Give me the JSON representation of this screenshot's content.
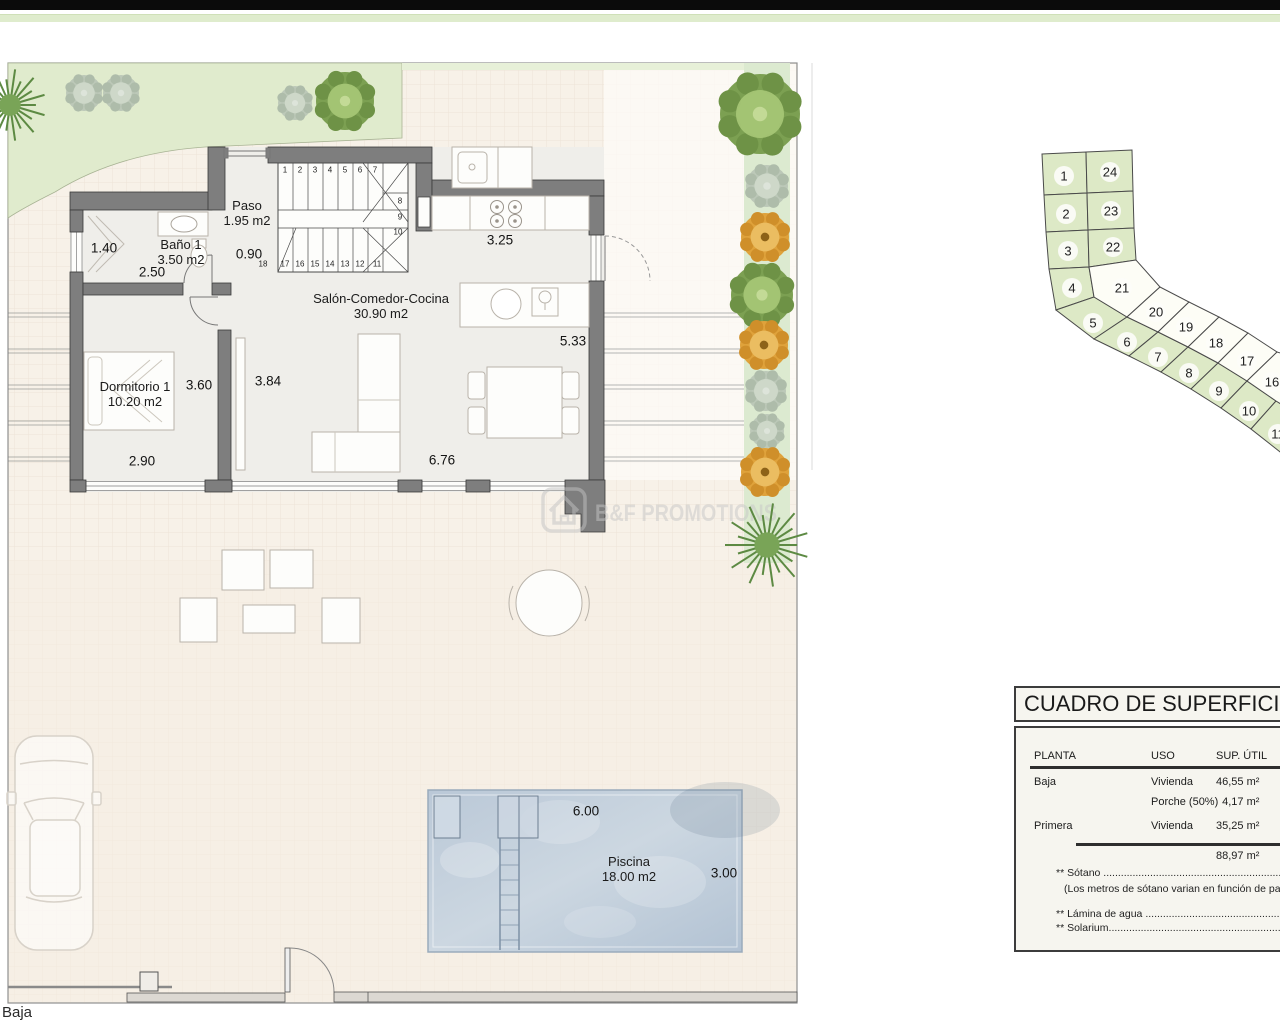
{
  "page": {
    "floor_label": "Baja"
  },
  "watermark": {
    "text": "B&F PROMOTIONS"
  },
  "rooms": [
    {
      "name": "Paso",
      "area": "1.95 m2",
      "x": 247,
      "y": 213
    },
    {
      "name": "Baño 1",
      "area": "3.50 m2",
      "x": 181,
      "y": 252
    },
    {
      "name": "Salón-Comedor-Cocina",
      "area": "30.90 m2",
      "x": 381,
      "y": 306
    },
    {
      "name": "Dormitorio 1",
      "area": "10.20 m2",
      "x": 135,
      "y": 394
    },
    {
      "name": "Piscina",
      "area": "18.00 m2",
      "x": 629,
      "y": 869
    }
  ],
  "dimensions": [
    {
      "text": "1.40",
      "x": 104,
      "y": 248
    },
    {
      "text": "2.50",
      "x": 152,
      "y": 272
    },
    {
      "text": "0.90",
      "x": 249,
      "y": 254
    },
    {
      "text": "3.25",
      "x": 500,
      "y": 240
    },
    {
      "text": "5.33",
      "x": 573,
      "y": 341
    },
    {
      "text": "3.60",
      "x": 199,
      "y": 385
    },
    {
      "text": "3.84",
      "x": 268,
      "y": 381
    },
    {
      "text": "2.90",
      "x": 142,
      "y": 461
    },
    {
      "text": "6.76",
      "x": 442,
      "y": 460
    },
    {
      "text": "6.00",
      "x": 586,
      "y": 811
    },
    {
      "text": "3.00",
      "x": 724,
      "y": 873
    }
  ],
  "stairs": {
    "numbers": [
      {
        "n": "1",
        "x": 285,
        "y": 170
      },
      {
        "n": "2",
        "x": 300,
        "y": 170
      },
      {
        "n": "3",
        "x": 315,
        "y": 170
      },
      {
        "n": "4",
        "x": 330,
        "y": 170
      },
      {
        "n": "5",
        "x": 345,
        "y": 170
      },
      {
        "n": "6",
        "x": 360,
        "y": 170
      },
      {
        "n": "7",
        "x": 375,
        "y": 170
      },
      {
        "n": "8",
        "x": 400,
        "y": 201
      },
      {
        "n": "9",
        "x": 400,
        "y": 217
      },
      {
        "n": "10",
        "x": 398,
        "y": 232
      },
      {
        "n": "18",
        "x": 263,
        "y": 264
      },
      {
        "n": "17",
        "x": 285,
        "y": 264
      },
      {
        "n": "16",
        "x": 300,
        "y": 264
      },
      {
        "n": "15",
        "x": 315,
        "y": 264
      },
      {
        "n": "14",
        "x": 330,
        "y": 264
      },
      {
        "n": "13",
        "x": 345,
        "y": 264
      },
      {
        "n": "12",
        "x": 360,
        "y": 264
      },
      {
        "n": "11",
        "x": 377,
        "y": 264
      }
    ]
  },
  "plot_map": {
    "green_color": "#dde9c6",
    "white_color": "#fdfdf6",
    "plots": [
      {
        "n": "1",
        "green": true,
        "points": "12,14 56,12 57,53 14,55",
        "lx": 34,
        "ly": 36
      },
      {
        "n": "2",
        "green": true,
        "points": "14,55 57,53 58,90 16,92",
        "lx": 36,
        "ly": 74
      },
      {
        "n": "3",
        "green": true,
        "points": "16,92 58,90 59,127 19,129",
        "lx": 38,
        "ly": 111
      },
      {
        "n": "4",
        "green": true,
        "points": "19,129 59,127 64,157 26,170",
        "lx": 42,
        "ly": 148
      },
      {
        "n": "5",
        "green": true,
        "points": "26,170 64,157 97,177 64,199",
        "lx": 63,
        "ly": 183
      },
      {
        "n": "6",
        "green": true,
        "points": "64,199 97,177 128,192 99,216",
        "lx": 97,
        "ly": 202
      },
      {
        "n": "7",
        "green": true,
        "points": "99,216 128,192 158,207 131,232",
        "lx": 128,
        "ly": 217
      },
      {
        "n": "8",
        "green": true,
        "points": "131,232 158,207 188,223 161,249",
        "lx": 159,
        "ly": 233
      },
      {
        "n": "9",
        "green": true,
        "points": "161,249 188,223 217,241 191,268",
        "lx": 189,
        "ly": 251
      },
      {
        "n": "10",
        "green": true,
        "points": "191,268 217,241 246,261 221,289",
        "lx": 219,
        "ly": 271
      },
      {
        "n": "11",
        "green": true,
        "points": "221,289 246,261 254,264 254,315",
        "lx": 248,
        "ly": 294
      },
      {
        "n": "24",
        "green": true,
        "points": "56,12 102,10 103,51 57,53",
        "lx": 80,
        "ly": 32
      },
      {
        "n": "23",
        "green": true,
        "points": "57,53 103,51 104,88 58,90",
        "lx": 81,
        "ly": 71
      },
      {
        "n": "22",
        "green": true,
        "points": "58,90 104,88 106,120 59,127",
        "lx": 83,
        "ly": 107
      },
      {
        "n": "21",
        "green": false,
        "points": "59,127 106,120 130,147 97,177 64,157",
        "lx": 92,
        "ly": 148
      },
      {
        "n": "20",
        "green": false,
        "points": "97,177 130,147 159,162 128,192",
        "lx": 126,
        "ly": 172
      },
      {
        "n": "19",
        "green": false,
        "points": "128,192 159,162 189,177 158,207",
        "lx": 156,
        "ly": 187
      },
      {
        "n": "18",
        "green": false,
        "points": "158,207 189,177 218,193 188,223",
        "lx": 186,
        "ly": 203
      },
      {
        "n": "17",
        "green": false,
        "points": "188,223 218,193 247,212 217,241",
        "lx": 217,
        "ly": 221
      },
      {
        "n": "16",
        "green": false,
        "points": "217,241 247,212 254,214 254,266 246,261",
        "lx": 242,
        "ly": 242
      }
    ]
  },
  "trees": [
    {
      "type": "palm",
      "x": 10,
      "y": 105,
      "r": 36
    },
    {
      "type": "gray",
      "x": 84,
      "y": 93,
      "r": 18
    },
    {
      "type": "gray",
      "x": 121,
      "y": 93,
      "r": 18
    },
    {
      "type": "gray",
      "x": 295,
      "y": 103,
      "r": 17
    },
    {
      "type": "green",
      "x": 345,
      "y": 101,
      "r": 29
    },
    {
      "type": "green",
      "x": 760,
      "y": 114,
      "r": 40
    },
    {
      "type": "gray",
      "x": 767,
      "y": 186,
      "r": 21
    },
    {
      "type": "orange",
      "x": 765,
      "y": 237,
      "r": 24
    },
    {
      "type": "green",
      "x": 762,
      "y": 295,
      "r": 31
    },
    {
      "type": "orange",
      "x": 764,
      "y": 345,
      "r": 24
    },
    {
      "type": "gray",
      "x": 766,
      "y": 391,
      "r": 20
    },
    {
      "type": "gray",
      "x": 767,
      "y": 431,
      "r": 17
    },
    {
      "type": "orange",
      "x": 765,
      "y": 472,
      "r": 24
    },
    {
      "type": "palm",
      "x": 767,
      "y": 545,
      "r": 42
    }
  ],
  "table": {
    "title": "CUADRO DE SUPERFICIES",
    "headers": [
      "PLANTA",
      "USO",
      "SUP. ÚTIL"
    ],
    "rows": [
      {
        "planta": "Baja",
        "uso": "Vivienda",
        "sup": "46,55 m²"
      },
      {
        "planta": "",
        "uso": "Porche (50%)",
        "sup": "  4,17 m²"
      },
      {
        "planta": "Primera",
        "uso": "Vivienda",
        "sup": "35,25 m²"
      }
    ],
    "total": "88,97 m²",
    "notes": [
      "** Sótano ................................................................................................",
      "(Los metros de sótano varian en función de parcela)",
      "** Lámina de agua ..............................................................................",
      "** Solarium........................................................................................."
    ]
  }
}
